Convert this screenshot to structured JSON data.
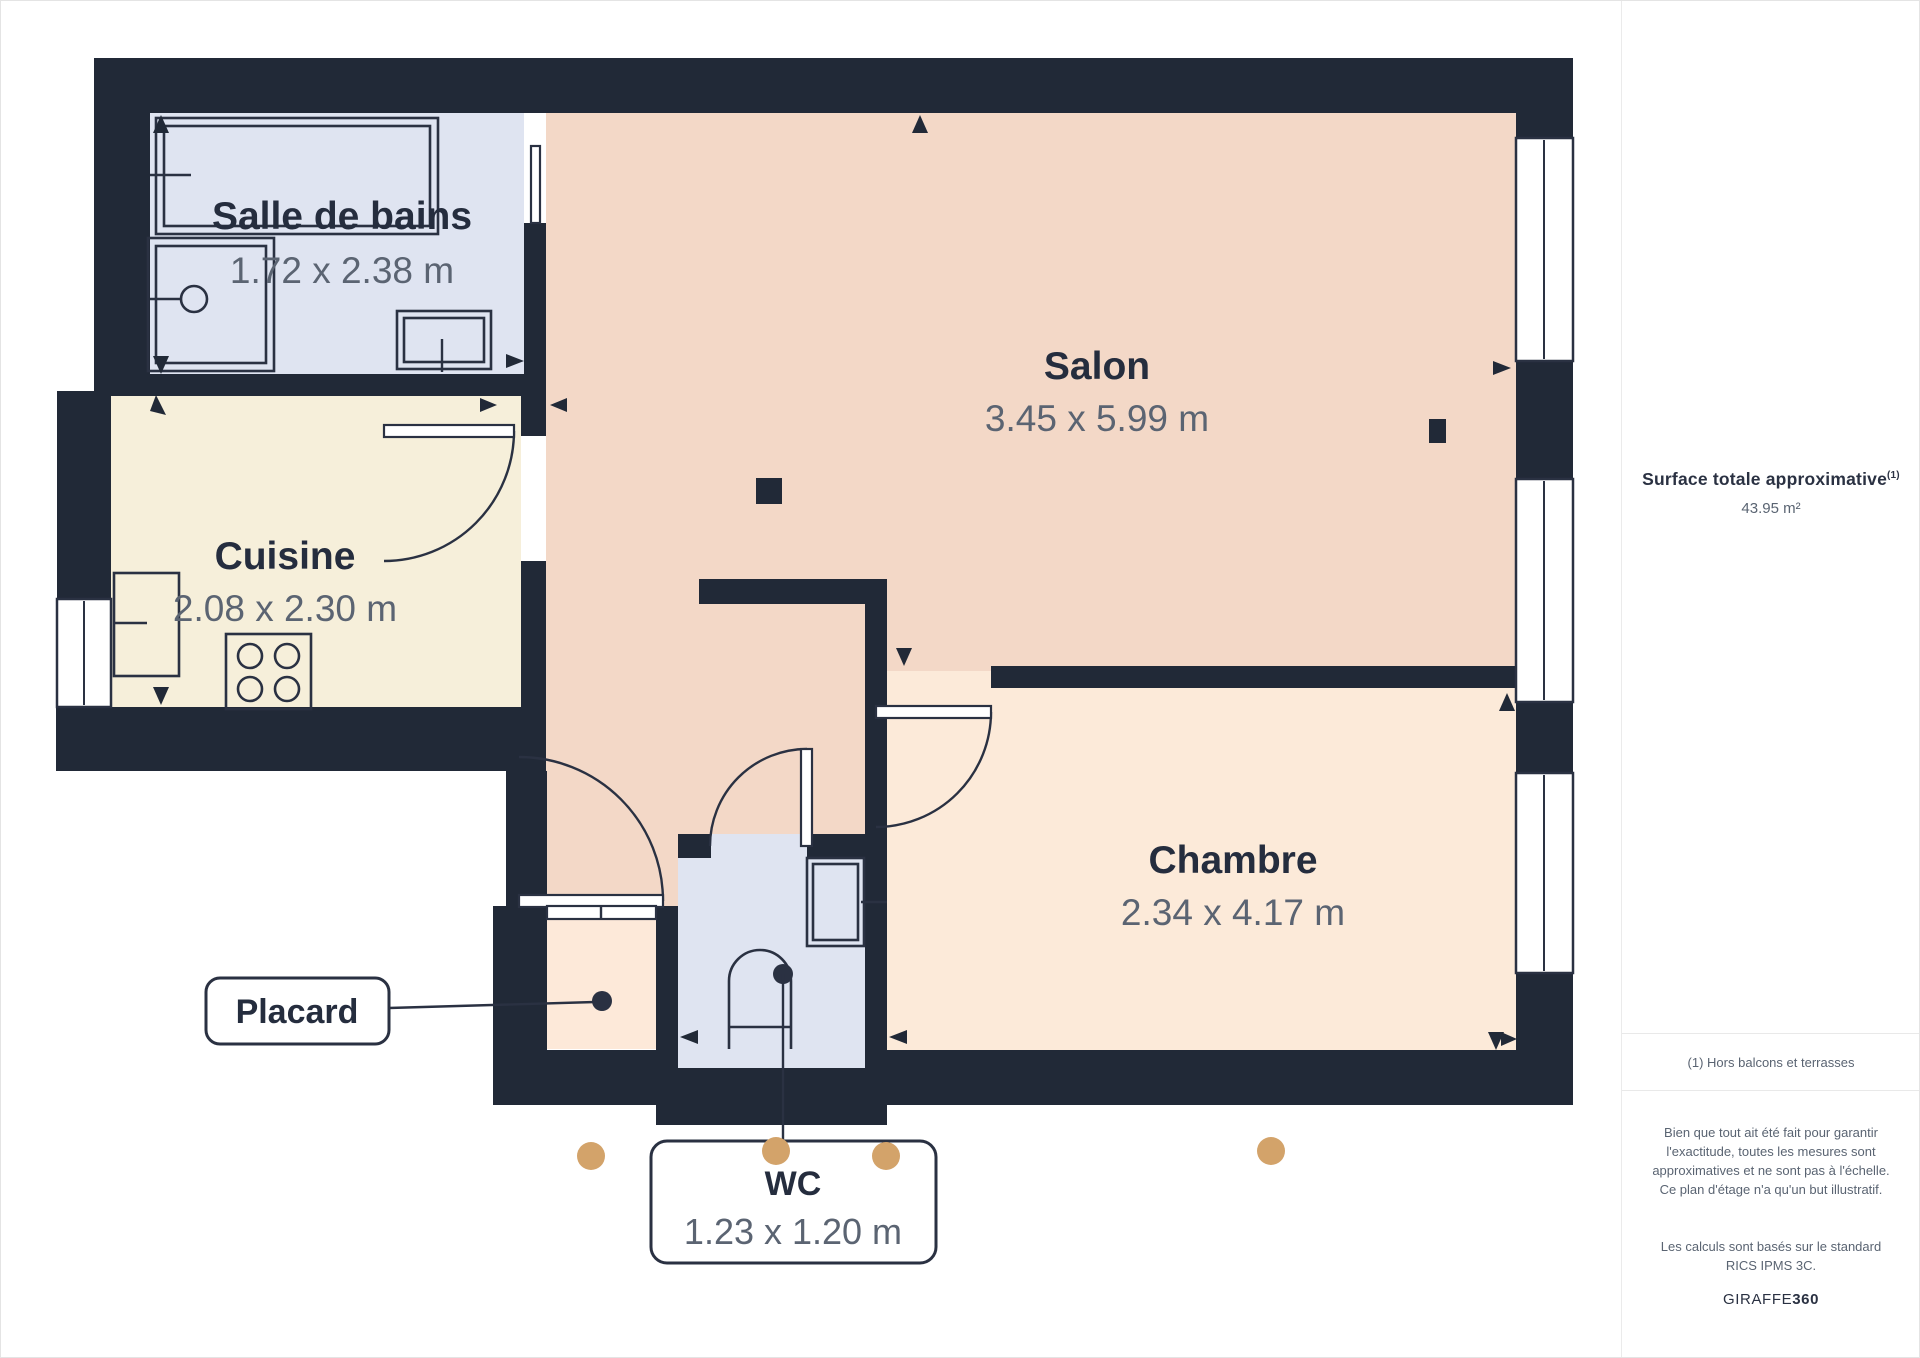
{
  "floor_plan": {
    "rooms": [
      {
        "name": "Salle de bains",
        "dims": "1.72 x 2.38 m"
      },
      {
        "name": "Cuisine",
        "dims": "2.08 x 2.30 m"
      },
      {
        "name": "Salon",
        "dims": "3.45 x 5.99 m"
      },
      {
        "name": "Chambre",
        "dims": "2.34 x 4.17 m"
      },
      {
        "name": "Placard"
      },
      {
        "name": "WC",
        "dims": "1.23 x 1.20 m"
      }
    ],
    "camera_dots": [
      [
        590,
        1155
      ],
      [
        775,
        1150
      ],
      [
        885,
        1155
      ],
      [
        1270,
        1150
      ]
    ]
  },
  "sidebar": {
    "title": "Surface totale approximative",
    "title_sup": "(1)",
    "value": "43.95 m²",
    "footnote": "(1) Hors balcons et terrasses",
    "disclaimer": "Bien que tout ait été fait pour garantir l'exactitude, toutes les mesures sont approximatives et ne sont pas à l'échelle. Ce plan d'étage n'a qu'un but illustratif.",
    "standard": "Les calculs sont basés sur le standard RICS IPMS 3C.",
    "brand_name": "GIRAFFE",
    "brand_bold": "360"
  },
  "colors": {
    "wall": "#212937",
    "line": "#2a3142",
    "salon_floor": "#f3d8c7",
    "chambre_floor": "#fcead9",
    "bathroom_floor": "#dfe4f1",
    "kitchen_floor": "#f6efda",
    "placard_floor": "#fde9d9",
    "camera_dot": "#d3a36a",
    "label_text": "#252d3e",
    "dim_text": "#5b6472"
  }
}
